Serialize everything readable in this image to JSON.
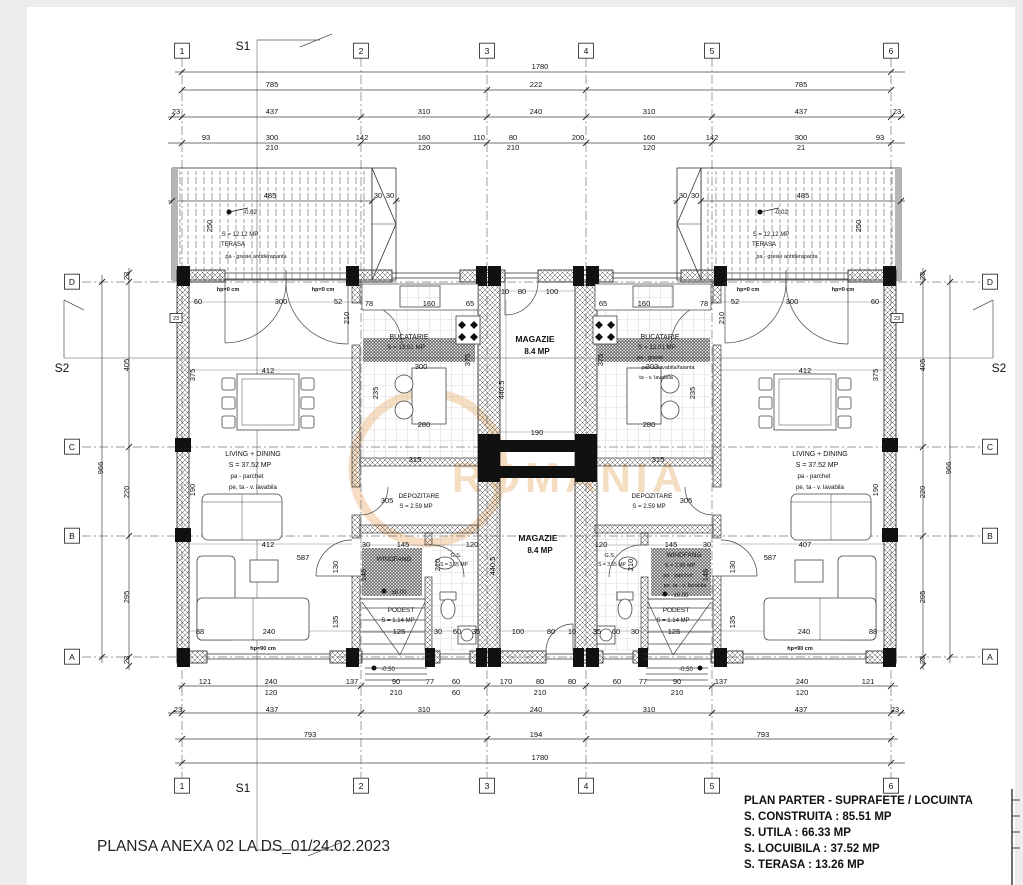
{
  "footer": {
    "text": "PLANSA ANEXA 02 LA DS_01/24.02.2023"
  },
  "title_block": {
    "title": "PLAN PARTER - SUPRAFETE / LOCUINTA",
    "lines": [
      "S. CONSTRUITA : 85.51 MP",
      "S. UTILA : 66.33 MP",
      "S. LOCUIBILA : 37.52 MP",
      "S. TERASA : 13.26 MP"
    ]
  },
  "watermark": {
    "text": "ROMANIA",
    "color": "#e09038"
  },
  "bubbles": [
    {
      "t": "1",
      "x": 182,
      "y": 54,
      "box": 1
    },
    {
      "t": "2",
      "x": 361,
      "y": 54,
      "box": 1
    },
    {
      "t": "3",
      "x": 487,
      "y": 54,
      "box": 1
    },
    {
      "t": "4",
      "x": 586,
      "y": 54,
      "box": 1
    },
    {
      "t": "5",
      "x": 712,
      "y": 54,
      "box": 1
    },
    {
      "t": "6",
      "x": 891,
      "y": 54,
      "box": 1
    },
    {
      "t": "1",
      "x": 182,
      "y": 789,
      "box": 1
    },
    {
      "t": "2",
      "x": 361,
      "y": 789,
      "box": 1
    },
    {
      "t": "3",
      "x": 487,
      "y": 789,
      "box": 1
    },
    {
      "t": "4",
      "x": 586,
      "y": 789,
      "box": 1
    },
    {
      "t": "5",
      "x": 712,
      "y": 789,
      "box": 1
    },
    {
      "t": "6",
      "x": 891,
      "y": 789,
      "box": 1
    },
    {
      "t": "D",
      "x": 72,
      "y": 285,
      "box": 1
    },
    {
      "t": "C",
      "x": 72,
      "y": 450,
      "box": 1
    },
    {
      "t": "B",
      "x": 72,
      "y": 539,
      "box": 1
    },
    {
      "t": "A",
      "x": 72,
      "y": 660,
      "box": 1
    },
    {
      "t": "D",
      "x": 990,
      "y": 285,
      "box": 1
    },
    {
      "t": "C",
      "x": 990,
      "y": 450,
      "box": 1
    },
    {
      "t": "B",
      "x": 990,
      "y": 539,
      "box": 1
    },
    {
      "t": "A",
      "x": 990,
      "y": 660,
      "box": 1
    }
  ],
  "section_labels": [
    {
      "t": "S1",
      "x": 243,
      "y": 50,
      "fs": 12
    },
    {
      "t": "S1",
      "x": 243,
      "y": 792,
      "fs": 12
    },
    {
      "t": "S2",
      "x": 62,
      "y": 372,
      "fs": 12
    },
    {
      "t": "S2",
      "x": 999,
      "y": 372,
      "fs": 12
    }
  ],
  "dim_labels": [
    {
      "t": "1780",
      "x": 540,
      "y": 69
    },
    {
      "t": "785",
      "x": 272,
      "y": 87
    },
    {
      "t": "222",
      "x": 536,
      "y": 87
    },
    {
      "t": "785",
      "x": 801,
      "y": 87
    },
    {
      "t": "23",
      "x": 176,
      "y": 114
    },
    {
      "t": "437",
      "x": 272,
      "y": 114
    },
    {
      "t": "310",
      "x": 424,
      "y": 114
    },
    {
      "t": "240",
      "x": 536,
      "y": 114
    },
    {
      "t": "310",
      "x": 649,
      "y": 114
    },
    {
      "t": "437",
      "x": 801,
      "y": 114
    },
    {
      "t": "23",
      "x": 897,
      "y": 114
    },
    {
      "t": "93",
      "x": 206,
      "y": 140
    },
    {
      "t": "300",
      "x": 272,
      "y": 140
    },
    {
      "t": "142",
      "x": 362,
      "y": 140
    },
    {
      "t": "160",
      "x": 424,
      "y": 140
    },
    {
      "t": "110",
      "x": 479,
      "y": 140
    },
    {
      "t": "80",
      "x": 513,
      "y": 140
    },
    {
      "t": "200",
      "x": 578,
      "y": 140
    },
    {
      "t": "160",
      "x": 649,
      "y": 140
    },
    {
      "t": "142",
      "x": 712,
      "y": 140
    },
    {
      "t": "300",
      "x": 801,
      "y": 140
    },
    {
      "t": "93",
      "x": 880,
      "y": 140
    },
    {
      "t": "210",
      "x": 272,
      "y": 150
    },
    {
      "t": "120",
      "x": 424,
      "y": 150
    },
    {
      "t": "210",
      "x": 513,
      "y": 150
    },
    {
      "t": "120",
      "x": 649,
      "y": 150
    },
    {
      "t": "21",
      "x": 801,
      "y": 150
    },
    {
      "t": "485",
      "x": 270,
      "y": 198
    },
    {
      "t": "30",
      "x": 378,
      "y": 198
    },
    {
      "t": "30",
      "x": 390,
      "y": 198
    },
    {
      "t": "30",
      "x": 683,
      "y": 198
    },
    {
      "t": "30",
      "x": 695,
      "y": 198
    },
    {
      "t": "485",
      "x": 803,
      "y": 198
    },
    {
      "t": "250",
      "x": 212,
      "y": 226,
      "r": -90
    },
    {
      "t": "250",
      "x": 861,
      "y": 226,
      "r": -90
    },
    {
      "t": "23",
      "x": 129,
      "y": 276,
      "r": -90
    },
    {
      "t": "405",
      "x": 129,
      "y": 365,
      "r": -90
    },
    {
      "t": "220",
      "x": 129,
      "y": 492,
      "r": -90
    },
    {
      "t": "295",
      "x": 129,
      "y": 597,
      "r": -90
    },
    {
      "t": "23",
      "x": 129,
      "y": 660,
      "r": -90
    },
    {
      "t": "966",
      "x": 103,
      "y": 468,
      "r": -90
    },
    {
      "t": "23",
      "x": 925,
      "y": 276,
      "r": -90
    },
    {
      "t": "405",
      "x": 925,
      "y": 365,
      "r": -90
    },
    {
      "t": "220",
      "x": 925,
      "y": 492,
      "r": -90
    },
    {
      "t": "295",
      "x": 925,
      "y": 597,
      "r": -90
    },
    {
      "t": "23",
      "x": 925,
      "y": 660,
      "r": -90
    },
    {
      "t": "966",
      "x": 951,
      "y": 468,
      "r": -90
    },
    {
      "t": "60",
      "x": 198,
      "y": 304
    },
    {
      "t": "300",
      "x": 281,
      "y": 304
    },
    {
      "t": "52",
      "x": 338,
      "y": 304
    },
    {
      "t": "78",
      "x": 369,
      "y": 306
    },
    {
      "t": "160",
      "x": 429,
      "y": 306
    },
    {
      "t": "65",
      "x": 470,
      "y": 306
    },
    {
      "t": "65",
      "x": 603,
      "y": 306
    },
    {
      "t": "160",
      "x": 644,
      "y": 306
    },
    {
      "t": "78",
      "x": 704,
      "y": 306
    },
    {
      "t": "52",
      "x": 735,
      "y": 304
    },
    {
      "t": "300",
      "x": 792,
      "y": 304
    },
    {
      "t": "60",
      "x": 875,
      "y": 304
    },
    {
      "t": "210",
      "x": 349,
      "y": 318,
      "r": -90
    },
    {
      "t": "210",
      "x": 724,
      "y": 318,
      "r": -90
    },
    {
      "t": "300",
      "x": 421,
      "y": 369
    },
    {
      "t": "303",
      "x": 652,
      "y": 369
    },
    {
      "t": "280",
      "x": 424,
      "y": 427
    },
    {
      "t": "280",
      "x": 649,
      "y": 427
    },
    {
      "t": "235",
      "x": 378,
      "y": 393,
      "r": -90
    },
    {
      "t": "235",
      "x": 695,
      "y": 393,
      "r": -90
    },
    {
      "t": "375",
      "x": 470,
      "y": 360,
      "r": -90
    },
    {
      "t": "375",
      "x": 603,
      "y": 360,
      "r": -90
    },
    {
      "t": "412",
      "x": 268,
      "y": 373
    },
    {
      "t": "412",
      "x": 805,
      "y": 373
    },
    {
      "t": "375",
      "x": 195,
      "y": 375,
      "r": -90
    },
    {
      "t": "375",
      "x": 878,
      "y": 375,
      "r": -90
    },
    {
      "t": "190",
      "x": 195,
      "y": 490,
      "r": -90
    },
    {
      "t": "190",
      "x": 878,
      "y": 490,
      "r": -90
    },
    {
      "t": "315",
      "x": 415,
      "y": 462
    },
    {
      "t": "315",
      "x": 658,
      "y": 462
    },
    {
      "t": "412",
      "x": 268,
      "y": 547
    },
    {
      "t": "587",
      "x": 303,
      "y": 560
    },
    {
      "t": "407",
      "x": 805,
      "y": 547
    },
    {
      "t": "587",
      "x": 770,
      "y": 560
    },
    {
      "t": "88",
      "x": 200,
      "y": 634
    },
    {
      "t": "240",
      "x": 269,
      "y": 634
    },
    {
      "t": "240",
      "x": 804,
      "y": 634
    },
    {
      "t": "88",
      "x": 873,
      "y": 634
    },
    {
      "t": "130",
      "x": 338,
      "y": 567,
      "r": -90
    },
    {
      "t": "130",
      "x": 735,
      "y": 567,
      "r": -90
    },
    {
      "t": "135",
      "x": 338,
      "y": 622,
      "r": -90
    },
    {
      "t": "135",
      "x": 735,
      "y": 622,
      "r": -90
    },
    {
      "t": "305",
      "x": 387,
      "y": 503
    },
    {
      "t": "305",
      "x": 686,
      "y": 503
    },
    {
      "t": "145",
      "x": 403,
      "y": 547
    },
    {
      "t": "145",
      "x": 671,
      "y": 547
    },
    {
      "t": "30",
      "x": 366,
      "y": 547
    },
    {
      "t": "30",
      "x": 707,
      "y": 547
    },
    {
      "t": "120",
      "x": 472,
      "y": 547
    },
    {
      "t": "120",
      "x": 601,
      "y": 547
    },
    {
      "t": "146",
      "x": 366,
      "y": 575,
      "r": -90
    },
    {
      "t": "146",
      "x": 708,
      "y": 575,
      "r": -90
    },
    {
      "t": "210",
      "x": 440,
      "y": 565,
      "r": -90
    },
    {
      "t": "210",
      "x": 633,
      "y": 565,
      "r": -90
    },
    {
      "t": "125",
      "x": 399,
      "y": 634
    },
    {
      "t": "125",
      "x": 674,
      "y": 634
    },
    {
      "t": "30",
      "x": 438,
      "y": 634
    },
    {
      "t": "60",
      "x": 457,
      "y": 634
    },
    {
      "t": "35",
      "x": 476,
      "y": 634
    },
    {
      "t": "35",
      "x": 597,
      "y": 634
    },
    {
      "t": "60",
      "x": 616,
      "y": 634
    },
    {
      "t": "30",
      "x": 635,
      "y": 634
    },
    {
      "t": "10",
      "x": 505,
      "y": 294
    },
    {
      "t": "80",
      "x": 522,
      "y": 294
    },
    {
      "t": "100",
      "x": 552,
      "y": 294
    },
    {
      "t": "190",
      "x": 537,
      "y": 435
    },
    {
      "t": "202",
      "x": 537,
      "y": 452
    },
    {
      "t": "190",
      "x": 537,
      "y": 478
    },
    {
      "t": "100",
      "x": 518,
      "y": 634
    },
    {
      "t": "80",
      "x": 551,
      "y": 634
    },
    {
      "t": "10",
      "x": 572,
      "y": 634
    },
    {
      "t": "440.5",
      "x": 504,
      "y": 390,
      "r": -90
    },
    {
      "t": "440.5",
      "x": 495,
      "y": 566,
      "r": -90
    },
    {
      "t": "121",
      "x": 205,
      "y": 684
    },
    {
      "t": "240",
      "x": 271,
      "y": 684
    },
    {
      "t": "137",
      "x": 352,
      "y": 684
    },
    {
      "t": "90",
      "x": 396,
      "y": 684
    },
    {
      "t": "77",
      "x": 430,
      "y": 684
    },
    {
      "t": "60",
      "x": 456,
      "y": 684
    },
    {
      "t": "170",
      "x": 506,
      "y": 684
    },
    {
      "t": "80",
      "x": 540,
      "y": 684
    },
    {
      "t": "80",
      "x": 572,
      "y": 684
    },
    {
      "t": "60",
      "x": 617,
      "y": 684
    },
    {
      "t": "77",
      "x": 643,
      "y": 684
    },
    {
      "t": "90",
      "x": 677,
      "y": 684
    },
    {
      "t": "137",
      "x": 721,
      "y": 684
    },
    {
      "t": "240",
      "x": 802,
      "y": 684
    },
    {
      "t": "121",
      "x": 868,
      "y": 684
    },
    {
      "t": "120",
      "x": 271,
      "y": 695
    },
    {
      "t": "210",
      "x": 396,
      "y": 695
    },
    {
      "t": "60",
      "x": 456,
      "y": 695
    },
    {
      "t": "210",
      "x": 540,
      "y": 695
    },
    {
      "t": "210",
      "x": 677,
      "y": 695
    },
    {
      "t": "120",
      "x": 802,
      "y": 695
    },
    {
      "t": "23",
      "x": 178,
      "y": 712
    },
    {
      "t": "437",
      "x": 272,
      "y": 712
    },
    {
      "t": "310",
      "x": 424,
      "y": 712
    },
    {
      "t": "240",
      "x": 536,
      "y": 712
    },
    {
      "t": "310",
      "x": 649,
      "y": 712
    },
    {
      "t": "437",
      "x": 801,
      "y": 712
    },
    {
      "t": "23",
      "x": 895,
      "y": 712
    },
    {
      "t": "793",
      "x": 310,
      "y": 737
    },
    {
      "t": "194",
      "x": 536,
      "y": 737
    },
    {
      "t": "793",
      "x": 763,
      "y": 737
    },
    {
      "t": "1780",
      "x": 540,
      "y": 760
    }
  ],
  "room_labels": [
    {
      "t": "LIVING + DINING",
      "x": 253,
      "y": 456,
      "fs": 7
    },
    {
      "t": "S = 37.52 MP",
      "x": 250,
      "y": 467,
      "fs": 7
    },
    {
      "t": "pa - parchet",
      "x": 247,
      "y": 478,
      "fs": 6.2
    },
    {
      "t": "pe, ta - v. lavabila",
      "x": 253,
      "y": 489,
      "fs": 6.2
    },
    {
      "t": "LIVING + DINING",
      "x": 820,
      "y": 456,
      "fs": 7
    },
    {
      "t": "S = 37.52 MP",
      "x": 817,
      "y": 467,
      "fs": 7
    },
    {
      "t": "pa - parchet",
      "x": 814,
      "y": 478,
      "fs": 6.2
    },
    {
      "t": "pe, ta - v. lavabila",
      "x": 820,
      "y": 489,
      "fs": 6.2
    },
    {
      "t": "BUCATARIE",
      "x": 409,
      "y": 339,
      "fs": 7
    },
    {
      "t": "S = 13.01 MP",
      "x": 406,
      "y": 349,
      "fs": 6.2
    },
    {
      "t": "BUCATARIE",
      "x": 660,
      "y": 339,
      "fs": 7
    },
    {
      "t": "S = 13.01 MP",
      "x": 657,
      "y": 349,
      "fs": 6.2
    },
    {
      "t": "pa - gresie",
      "x": 650,
      "y": 359,
      "fs": 5.5
    },
    {
      "t": "pe - v. lavabila/faianta",
      "x": 668,
      "y": 369,
      "fs": 5.5
    },
    {
      "t": "ta - v. lavabila",
      "x": 656,
      "y": 379,
      "fs": 5.5
    },
    {
      "t": "DEPOZITARE",
      "x": 419,
      "y": 498,
      "fs": 6.5
    },
    {
      "t": "S = 2.59 MP",
      "x": 416,
      "y": 508,
      "fs": 6
    },
    {
      "t": "DEPOZITARE",
      "x": 652,
      "y": 498,
      "fs": 6.5
    },
    {
      "t": "S = 2.59 MP",
      "x": 649,
      "y": 508,
      "fs": 6
    },
    {
      "t": "WINDFANG",
      "x": 394,
      "y": 561,
      "fs": 6.5
    },
    {
      "t": "WINDFANG",
      "x": 684,
      "y": 557,
      "fs": 6.5
    },
    {
      "t": "S = 2.95 MP",
      "x": 680,
      "y": 567,
      "fs": 5.5
    },
    {
      "t": "pa - parchet",
      "x": 678,
      "y": 577,
      "fs": 5.5
    },
    {
      "t": "pe, ta - v. lavabila",
      "x": 685,
      "y": 587,
      "fs": 5.5
    },
    {
      "t": "PODEST",
      "x": 401,
      "y": 612,
      "fs": 6.5
    },
    {
      "t": "S = 1.14 MP",
      "x": 398,
      "y": 622,
      "fs": 6
    },
    {
      "t": "PODEST",
      "x": 676,
      "y": 612,
      "fs": 6.5
    },
    {
      "t": "S = 1.14 MP",
      "x": 673,
      "y": 622,
      "fs": 6
    },
    {
      "t": "G.S.",
      "x": 456,
      "y": 557,
      "fs": 5.5
    },
    {
      "t": "S = 3.55 MP",
      "x": 454,
      "y": 566,
      "fs": 5
    },
    {
      "t": "G.S.",
      "x": 610,
      "y": 557,
      "fs": 5.5
    },
    {
      "t": "S = 3.55 MP",
      "x": 612,
      "y": 566,
      "fs": 5
    },
    {
      "t": "MAGAZIE",
      "x": 535,
      "y": 342,
      "fs": 8.5,
      "b": 1
    },
    {
      "t": "8.4 MP",
      "x": 537,
      "y": 354,
      "fs": 8,
      "b": 1
    },
    {
      "t": "MAGAZIE",
      "x": 538,
      "y": 541,
      "fs": 8.5,
      "b": 1
    },
    {
      "t": "8.4 MP",
      "x": 540,
      "y": 553,
      "fs": 8,
      "b": 1
    }
  ],
  "annot_labels": [
    {
      "t": "hp=0 cm",
      "x": 228,
      "y": 291,
      "fs": 5.5,
      "b": 1
    },
    {
      "t": "hp=0 cm",
      "x": 323,
      "y": 291,
      "fs": 5.5,
      "b": 1
    },
    {
      "t": "hp=0 cm",
      "x": 748,
      "y": 291,
      "fs": 5.5,
      "b": 1
    },
    {
      "t": "hp=0 cm",
      "x": 843,
      "y": 291,
      "fs": 5.5,
      "b": 1
    },
    {
      "t": "hp=90 cm",
      "x": 263,
      "y": 650,
      "fs": 5.5,
      "b": 1
    },
    {
      "t": "hp=90 cm",
      "x": 800,
      "y": 650,
      "fs": 5.5,
      "b": 1
    },
    {
      "t": "-0.02",
      "x": 250,
      "y": 214,
      "fs": 6
    },
    {
      "t": "-0.02",
      "x": 781,
      "y": 214,
      "fs": 6
    },
    {
      "t": "±0.00",
      "x": 399,
      "y": 594,
      "fs": 6
    },
    {
      "t": "±0.00",
      "x": 681,
      "y": 597,
      "fs": 6
    },
    {
      "t": "-0.50",
      "x": 388,
      "y": 671,
      "fs": 6
    },
    {
      "t": "-0.50",
      "x": 686,
      "y": 671,
      "fs": 6
    },
    {
      "t": "S = 12.12 MP",
      "x": 240,
      "y": 236,
      "fs": 6
    },
    {
      "t": "TERASA",
      "x": 233,
      "y": 246,
      "fs": 6
    },
    {
      "t": "pa - gresie antiderapanta",
      "x": 256,
      "y": 258,
      "fs": 5.5
    },
    {
      "t": "S = 12.12 MP",
      "x": 771,
      "y": 236,
      "fs": 6
    },
    {
      "t": "TERASA",
      "x": 764,
      "y": 246,
      "fs": 6
    },
    {
      "t": "pa - gresie antiderapanta",
      "x": 787,
      "y": 258,
      "fs": 5.5
    },
    {
      "t": "23",
      "x": 176,
      "y": 320,
      "fs": 5.5,
      "box": 1,
      "bw": 12,
      "bh": 9
    },
    {
      "t": "23",
      "x": 897,
      "y": 320,
      "fs": 5.5,
      "box": 1,
      "bw": 12,
      "bh": 9
    }
  ]
}
